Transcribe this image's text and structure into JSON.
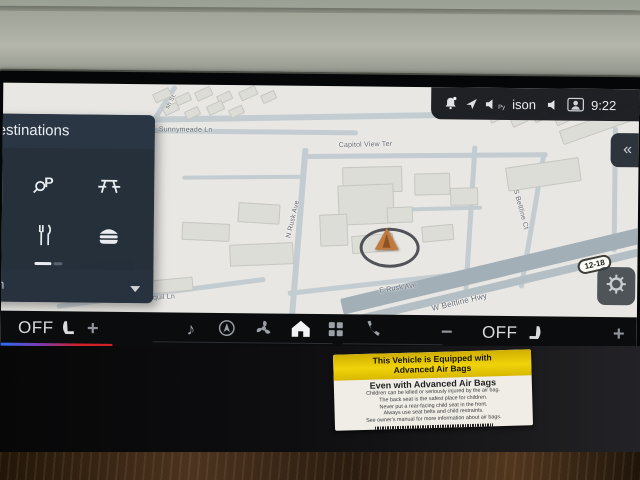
{
  "status_bar": {
    "py_label": "Py",
    "audio_text": "ison",
    "time": "9:22"
  },
  "panel": {
    "title": "Destinations",
    "search": "Search"
  },
  "map": {
    "labels": {
      "sunnymeade": "Sunnymeade Ln",
      "sh_st": "sh St.",
      "capitol": "Capitol View Ter",
      "n_rusk": "N Rusk Ave",
      "e_rusk": "E Rusk Ave",
      "beltline_hwy": "W Beltline Hwy",
      "beltline_ct": "S Beltline Ct",
      "jonquil": "Jonquil Ln"
    },
    "shield": "12-18"
  },
  "dock": {
    "left": {
      "off": "OFF",
      "plus": "+"
    },
    "right": {
      "minus": "−",
      "off": "OFF",
      "plus": "+"
    }
  },
  "sticker": {
    "band1": "This Vehicle is Equipped with",
    "band2": "Advanced Air Bags",
    "header": "Even with Advanced Air Bags",
    "lines": [
      "Children can be killed or seriously injured by the air bag.",
      "The back seat is the safest place for children.",
      "Never put a rear-facing child seat in the front.",
      "Always use seat belts and child restraints.",
      "See owner's manual for more information about air bags."
    ]
  },
  "colors": {
    "climate_cold": "#2a6df5",
    "climate_hot": "#cf2128",
    "sticker_yellow": "#e6c70d",
    "marker_orange": "#c07a3e",
    "map_bg": "#e8e7e3",
    "panel_bg": "#202b37"
  },
  "icons": [
    "bell-icon",
    "location-arrow-icon",
    "speaker-icon",
    "muted-speaker-icon",
    "driver-profile-icon",
    "parking-search-icon",
    "picnic-area-icon",
    "restaurant-icon",
    "fast-food-icon",
    "chevron-down-icon",
    "heated-seat-icon",
    "music-note-icon",
    "navigation-icon",
    "fan-icon",
    "home-icon",
    "app-grid-icon",
    "phone-icon",
    "gear-icon",
    "chevron-left-icon"
  ]
}
